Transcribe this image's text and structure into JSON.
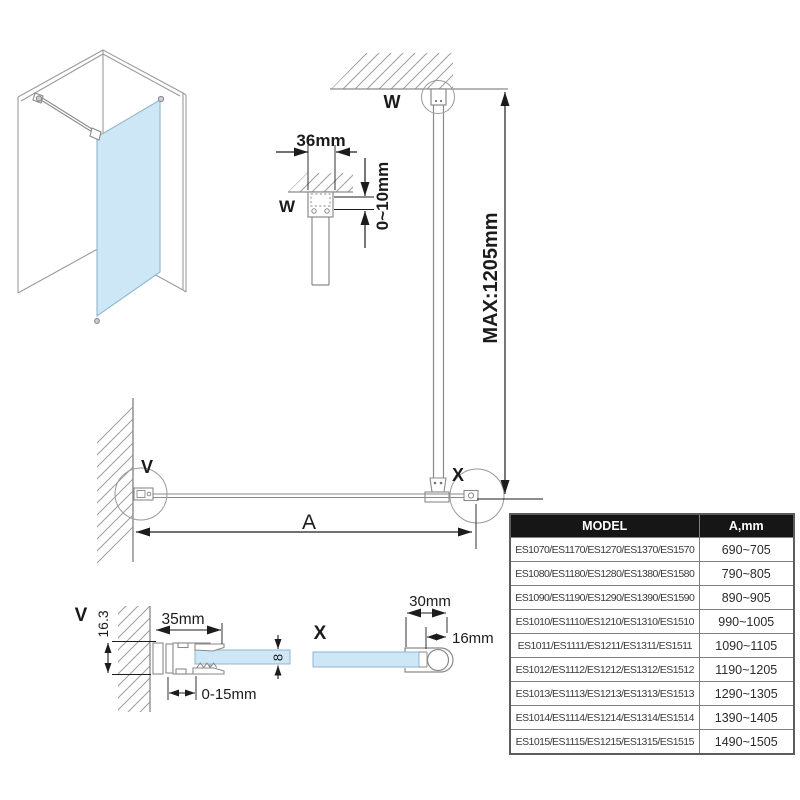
{
  "drawing_title": "walk-in shower glass panel installation drawing",
  "colors": {
    "glass": "#cde7f6",
    "glass_edge": "#92b6cc",
    "shape_gray": "#8a8a8a",
    "dim_dark": "#1c1c1c",
    "table_header_bg": "#161616",
    "table_header_text": "#ffffff"
  },
  "labels": {
    "w_top": "W",
    "w_detail": "W",
    "v_plan": "V",
    "x_plan": "X",
    "v_detail": "V",
    "x_detail": "X"
  },
  "dims": {
    "bracket_width": "36mm",
    "ceiling_gap": "0~10mm",
    "bar_max": "MAX:1205mm",
    "panel_width": "A",
    "profile_depth": "16.3",
    "profile_width": "35mm",
    "adjust_range": "0-15mm",
    "glass_thickness": "8",
    "end_profile_width": "30mm",
    "end_tube_width": "16mm"
  },
  "table": {
    "headers": {
      "model": "MODEL",
      "a": "A,mm"
    },
    "rows": [
      {
        "model": "ES1070/ES1170/ES1270/ES1370/ES1570",
        "a": "690~705"
      },
      {
        "model": "ES1080/ES1180/ES1280/ES1380/ES1580",
        "a": "790~805"
      },
      {
        "model": "ES1090/ES1190/ES1290/ES1390/ES1590",
        "a": "890~905"
      },
      {
        "model": "ES1010/ES1110/ES1210/ES1310/ES1510",
        "a": "990~1005"
      },
      {
        "model": "ES1011/ES1111/ES1211/ES1311/ES1511",
        "a": "1090~1105"
      },
      {
        "model": "ES1012/ES1112/ES1212/ES1312/ES1512",
        "a": "1190~1205"
      },
      {
        "model": "ES1013/ES1113/ES1213/ES1313/ES1513",
        "a": "1290~1305"
      },
      {
        "model": "ES1014/ES1114/ES1214/ES1314/ES1514",
        "a": "1390~1405"
      },
      {
        "model": "ES1015/ES1115/ES1215/ES1315/ES1515",
        "a": "1490~1505"
      }
    ]
  }
}
